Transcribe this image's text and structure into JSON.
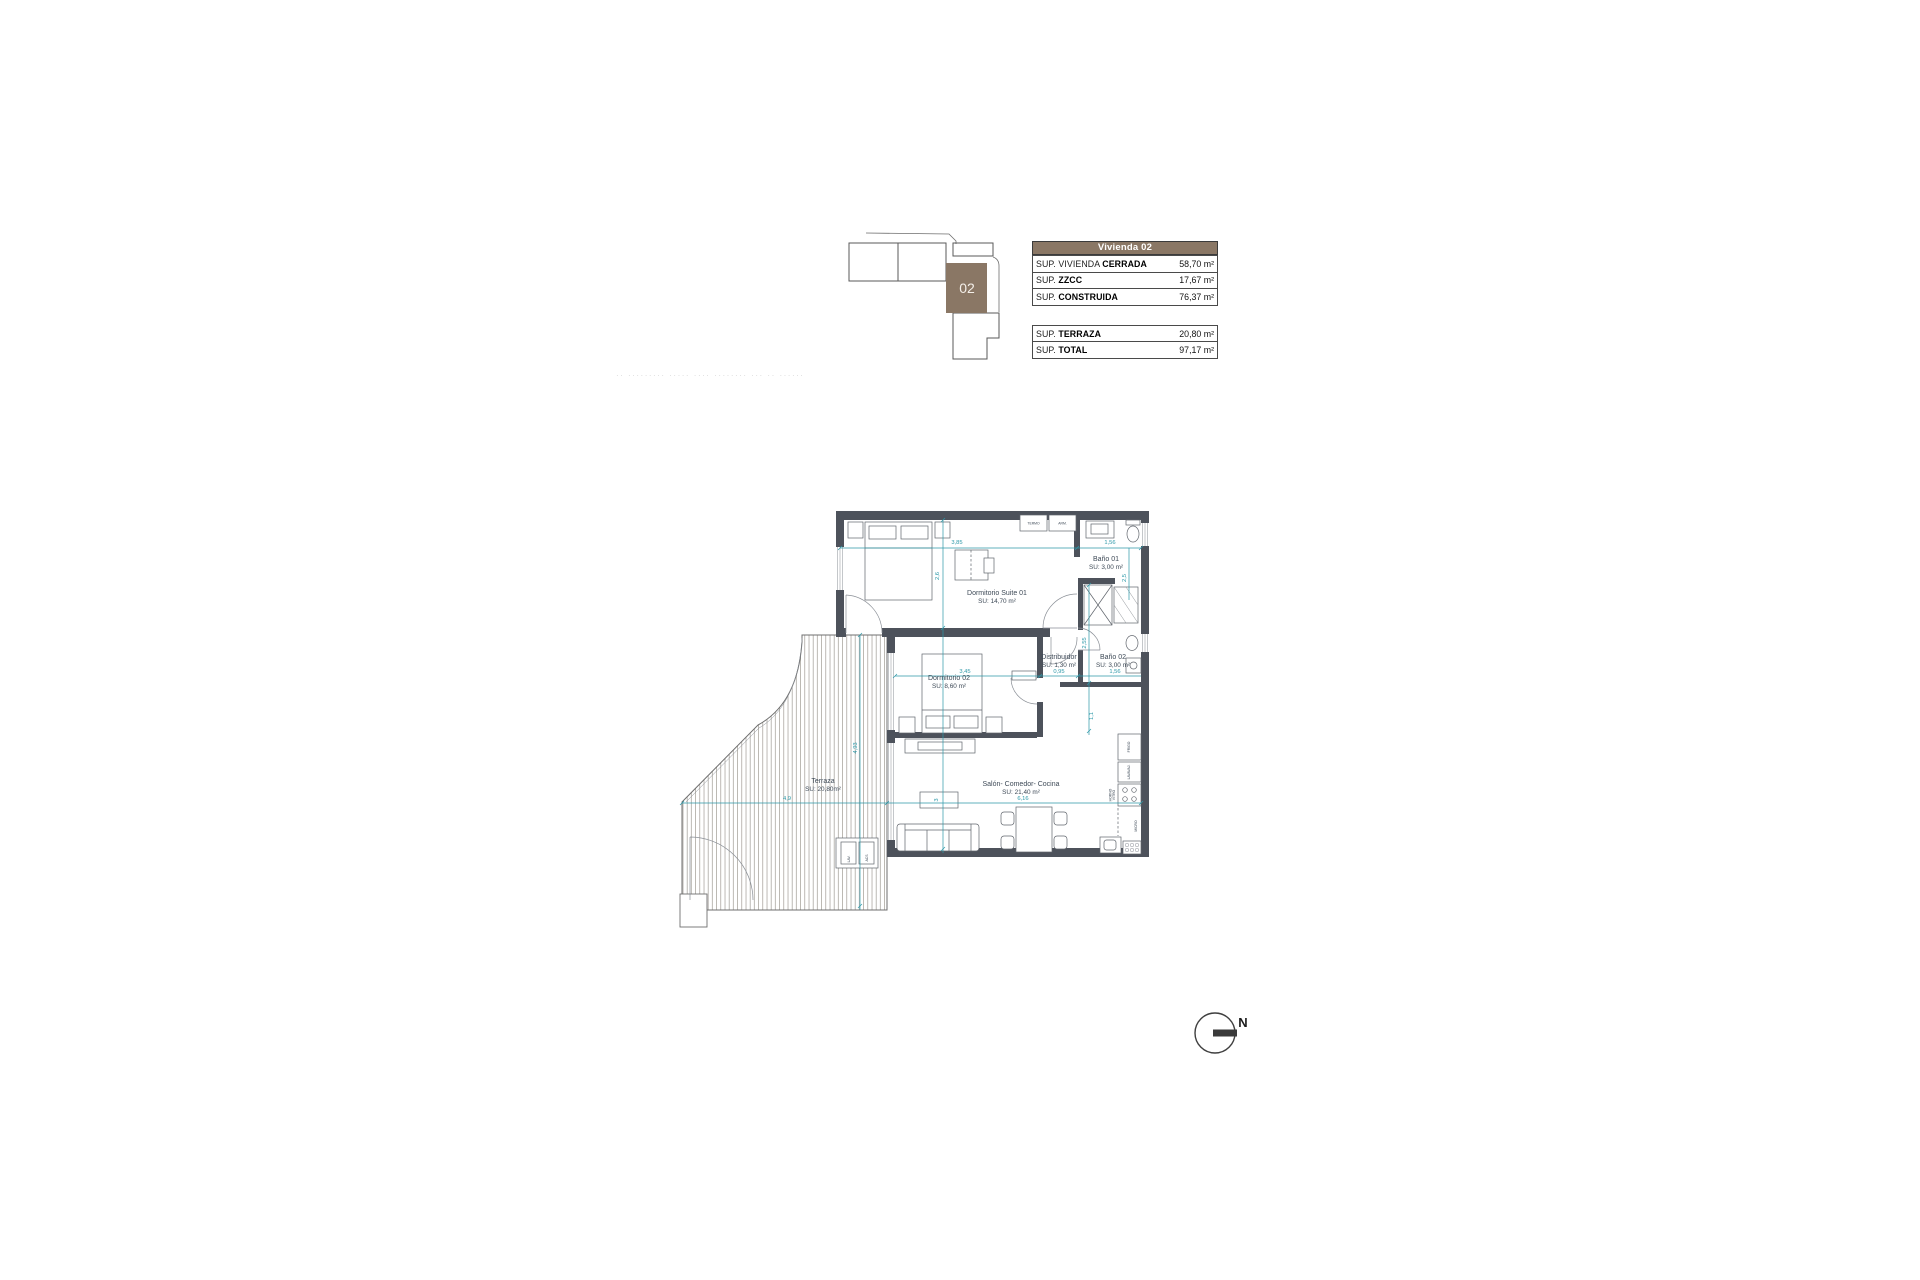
{
  "key_plan": {
    "unit": "02"
  },
  "table": {
    "header": "Vivienda 02",
    "rows": [
      {
        "label_light": "SUP. VIVIENDA ",
        "label_bold": "CERRADA",
        "value": "58,70 m²"
      },
      {
        "label_light": "SUP. ",
        "label_bold": "ZZCC",
        "value": "17,67 m²"
      },
      {
        "label_light": "SUP. ",
        "label_bold": "CONSTRUIDA",
        "value": "76,37 m²"
      },
      {
        "label_light": "SUP. ",
        "label_bold": "TERRAZA",
        "value": "20,80 m²"
      },
      {
        "label_light": "SUP. ",
        "label_bold": "TOTAL",
        "value": "97,17 m²"
      }
    ]
  },
  "rooms": {
    "suite": {
      "name": "Dormitorio Suite  01",
      "area": "SU: 14,70 m²"
    },
    "bano1": {
      "name": "Baño 01",
      "area": "SU: 3,00 m²"
    },
    "bano2": {
      "name": "Baño 02",
      "area": "SU: 3,00 m²"
    },
    "distribuidor": {
      "name": "Distribuidor",
      "area": "SU: 1,30 m²"
    },
    "dorm2": {
      "name": "Dormitorio 02",
      "area": "SU: 8,60 m²"
    },
    "salon": {
      "name": "Salón- Comedor- Cocina",
      "area": "SU: 21,40 m²"
    },
    "terraza": {
      "name": "Terraza",
      "area": "SU: 20,80m²"
    }
  },
  "dims": {
    "suite_width": "3,85",
    "bano1_width": "1,56",
    "suite_height": "2,6",
    "bano1_height": "2,5",
    "hall_height": "2,55",
    "hall_lower": "1,1",
    "dorm2_width": "3,45",
    "distribuidor_width": "0,95",
    "bano2_width": "1,56",
    "terraza_height": "4,93",
    "terraza_width": "4,9",
    "salon_width": "6,16",
    "sofa_depth": "3"
  },
  "labels": {
    "termo": "TERMO",
    "armario": "ARM.",
    "lav": "LAV.",
    "acs": "ACS",
    "frigo": "FRIGO",
    "lavavajillas": "LAVAVAJ.",
    "vitro": "VITRO",
    "horno": "HORNO",
    "micro": "MICRO"
  },
  "compass": {
    "north": "N"
  },
  "watermark": {
    "text": "·· ········· ····· ···· ········ ··· ·· ······"
  },
  "colors": {
    "brand_brown": "#8a7765",
    "wall": "#4d525b",
    "dimension_teal": "#2c98a8"
  }
}
